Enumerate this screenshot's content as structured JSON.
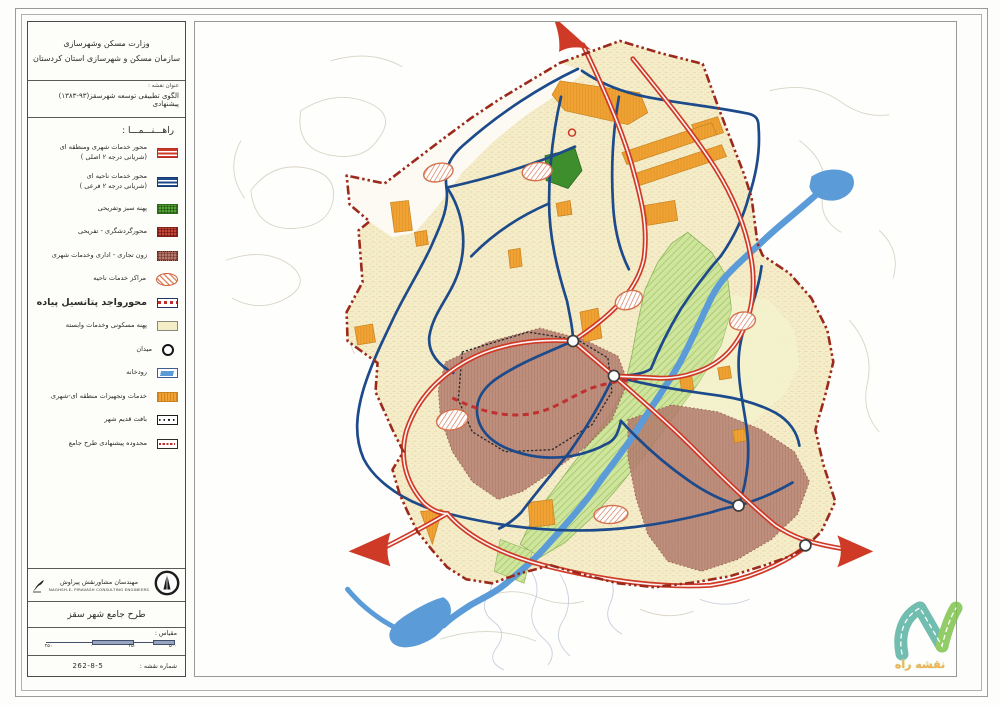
{
  "header": {
    "ministry": "وزارت مسکن وشهرسازی",
    "organization": "سازمان مسکن و شهرسازی استان کردستان"
  },
  "title_block": {
    "label": "عنوان نقشه :",
    "title": "الگوی تطبیقی توسعه شهرسقز(‎۱۳۸۳-۹۳‎) پیشنهادی"
  },
  "legend": {
    "heading": "راهـــنـــمـــا :",
    "items": [
      {
        "id": "urban-regional-services-axis",
        "icon": "red-road",
        "label": "محور خدمات شهری ومنطقه ای",
        "label2": "(شریانی درجه ۲ اصلی )"
      },
      {
        "id": "district-services-axis",
        "icon": "blue-road",
        "label": "محور خدمات ناحیه ای",
        "label2": "(شریانی درجه ۲ فرعی )"
      },
      {
        "id": "green-recreation-zone",
        "icon": "green-hatch",
        "label": "پهنه سبز وتفریحی"
      },
      {
        "id": "tourism-recreation-axis",
        "icon": "red-hatch",
        "label": "محورگردشگری - تفریحی"
      },
      {
        "id": "commercial-admin-zone",
        "icon": "brown-hatch",
        "label": "زون تجاری - اداری وخدمات شهری"
      },
      {
        "id": "district-service-centers",
        "icon": "hatched-ellipse",
        "label": "مراکز خدمات ناحیه"
      },
      {
        "id": "pedestrian-potential-axis",
        "icon": "red-dash-box",
        "label": "محورواجد پتانسیل پیاده",
        "big": true
      },
      {
        "id": "residential-zone",
        "icon": "cream-box",
        "label": "پهنه مسکونی وخدمات وابسته"
      },
      {
        "id": "plaza",
        "icon": "circle",
        "label": "میدان"
      },
      {
        "id": "river",
        "icon": "river",
        "label": "رودخانه"
      },
      {
        "id": "regional-urban-services",
        "icon": "orange-box",
        "label": "خدمات وتجهیزات منطقه ای-شهری"
      },
      {
        "id": "old-city-fabric",
        "icon": "dotted-box",
        "label": "بافت قدیم شهر"
      },
      {
        "id": "master-plan-boundary",
        "icon": "dashdot-box",
        "label": "محدوده پیشنهادی طرح جامع"
      }
    ]
  },
  "consultant": {
    "name_fa": "مهندسان مشاورنقش پیراوش",
    "name_en": "NAGHSH-E- PIRAVASH CONSULTING ENGINEERS"
  },
  "project": {
    "name": "طرح جامع شهر سقز"
  },
  "scale": {
    "label": "مقیاس :",
    "ticks": [
      "۲۵۰",
      "۰",
      "۲۵۰",
      "۵۰۰"
    ]
  },
  "sheet_number": {
    "label": "شماره نقشه :",
    "value": "262-8-5"
  },
  "watermark": {
    "text": "نقشه راه"
  },
  "colors": {
    "cream": "#f5edc8",
    "boundary_red": "#9c2a1c",
    "road_red": "#cf3a27",
    "road_blue": "#1d4a8a",
    "river_blue": "#5a9bd8",
    "corridor_green": "#cfe49c",
    "corridor_hatch": "#9cc463",
    "park_green": "#3e8e2e",
    "services_orange": "#f0a233",
    "zone_brown": "#b57f71",
    "hatch_red": "#d4714d",
    "pedestrian_red": "#c03030",
    "sketch_gray": "#d2ccbd",
    "sketch_blue": "#c3cada"
  }
}
